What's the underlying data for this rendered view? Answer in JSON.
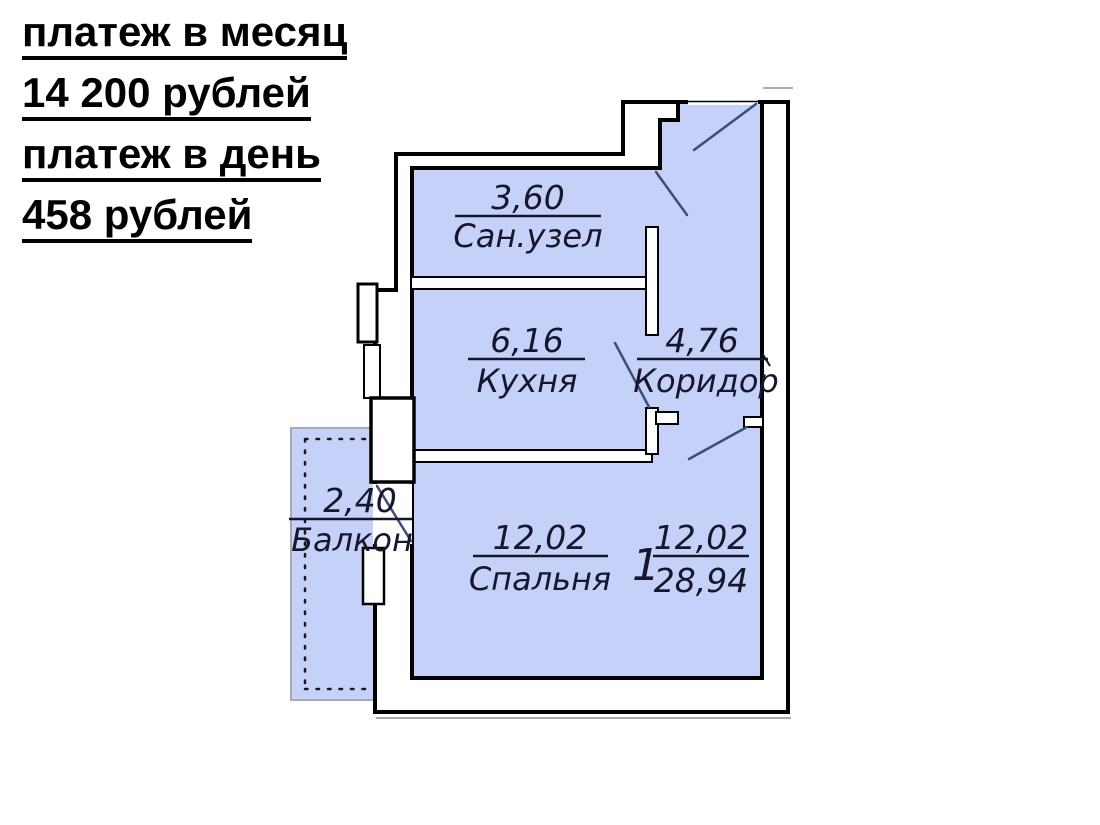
{
  "payment": {
    "monthly_label": "платеж в месяц",
    "monthly_amount": "14 200 рублей",
    "daily_label": "платеж в день",
    "daily_amount": "458 рублей"
  },
  "floor_plan": {
    "unit": {
      "number": "1",
      "living_area": "12,02",
      "total_area": "28,94"
    },
    "rooms": {
      "bathroom": {
        "name": "Сан.узел",
        "area": "3,60"
      },
      "kitchen": {
        "name": "Кухня",
        "area": "6,16"
      },
      "corridor": {
        "name": "Коридор",
        "area": "4,76"
      },
      "bedroom": {
        "name": "Спальня",
        "area": "12,02"
      },
      "balcony": {
        "name": "Балкон",
        "area": "2,40"
      }
    },
    "colors": {
      "room_fill": "#c6d1fa",
      "wall": "#000000",
      "door_swing": "#3d4e75",
      "outline_gray": "#a9a9b0"
    }
  }
}
